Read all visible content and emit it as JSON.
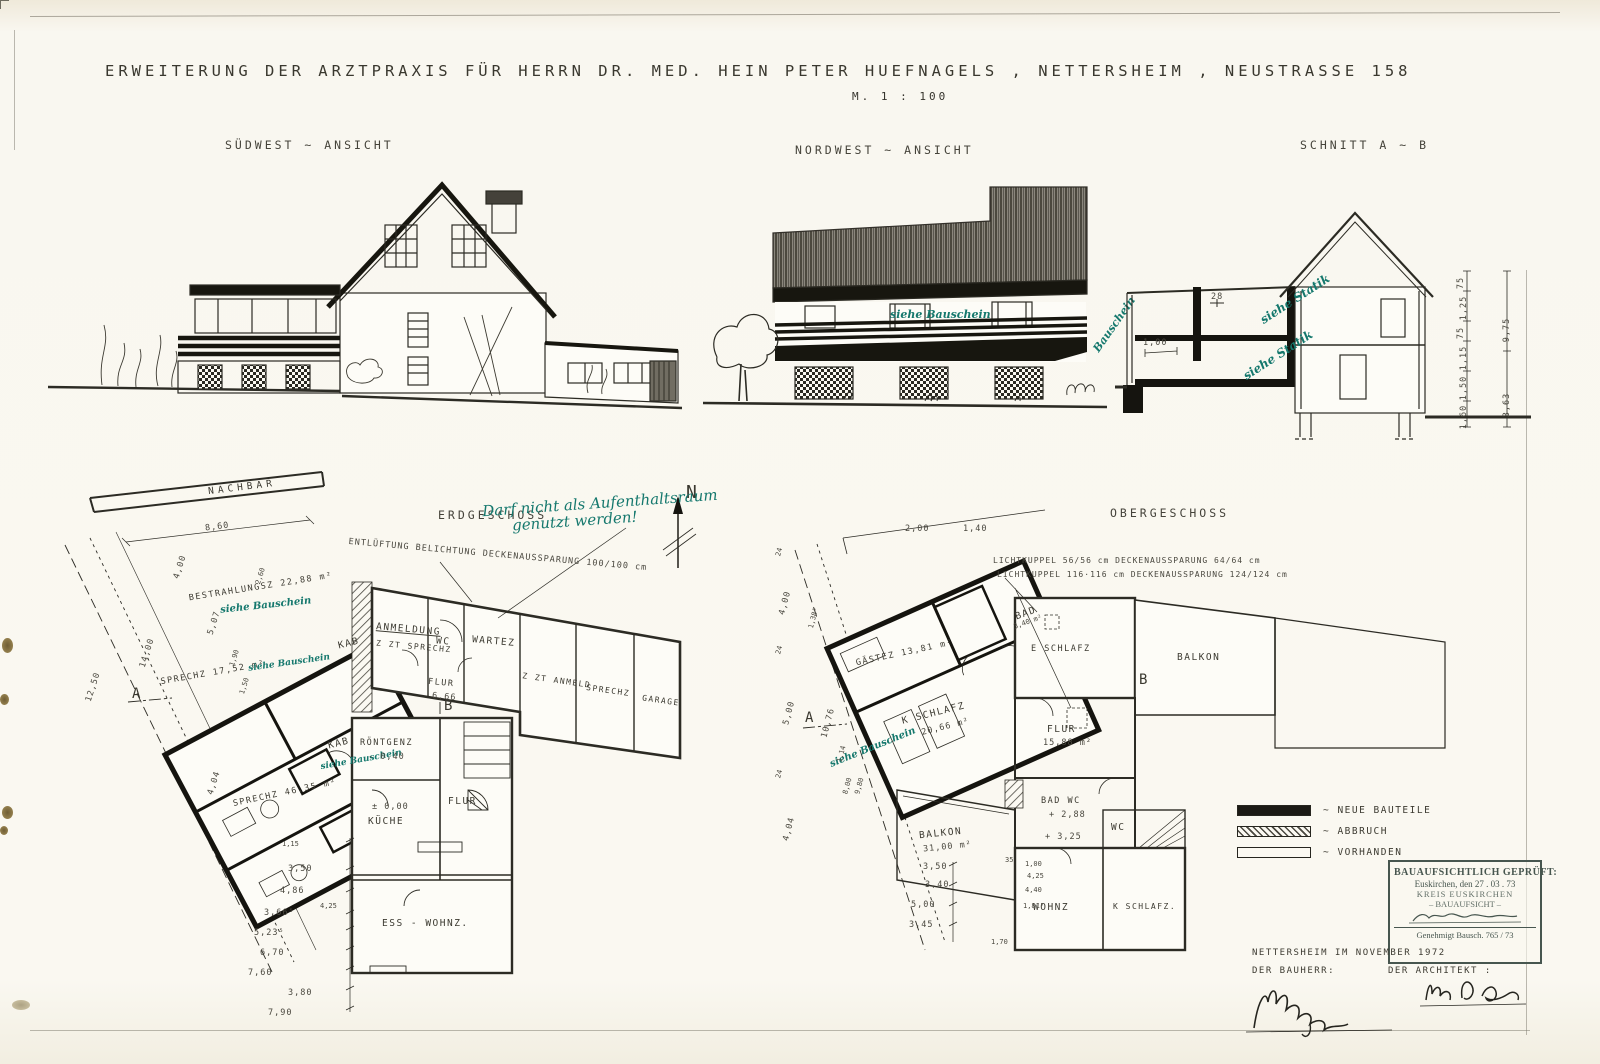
{
  "title": {
    "main": "ERWEITERUNG  DER  ARZTPRAXIS  FÜR  HERRN  DR. MED.  HEIN  PETER  HUEFNAGELS  , NETTERSHEIM ,  NEUSTRASSE   158",
    "scale": "M. 1 : 100"
  },
  "views": {
    "sw": "SÜDWEST  ~ ANSICHT",
    "nw": "NORDWEST  ~ ANSICHT",
    "schnitt": "SCHNITT   A ~ B"
  },
  "nw": {
    "siehe": "siehe Bauschein",
    "bauschein_rot": "Bauschein"
  },
  "schnitt": {
    "statik1": "siehe Statik",
    "statik2": "siehe Statik",
    "lvl": "28",
    "dim100": "1,00",
    "dims": [
      "75",
      "1,25",
      "75",
      "1,15",
      "1,50",
      "1,60"
    ],
    "dims2": [
      "9,75",
      "3,63"
    ]
  },
  "eg": {
    "title": "ERDGESCHOSS",
    "compass": "N",
    "nachbar": "NACHBAR",
    "dim860": "8,60",
    "note1": "Darf nicht als Aufenthaltsraum",
    "note2": "genutzt werden!",
    "vent": "ENTLÜFTUNG  BELICHTUNG  DECKENAUSSPARUNG  100/100 cm",
    "rooms": {
      "bestrahlungsz": "BESTRAHLUNGSZ  22,88 m²",
      "siehe1": "siehe Bauschein",
      "sprechz1": "SPRECHZ  17,52 m²",
      "siehe2": "siehe Bauschein",
      "kab1": "KAB",
      "kab2": "KAB",
      "siehe3": "siehe Bauschein",
      "sprechz3": "SPRECHZ  46,35 m²",
      "anmeldung1": "ANMELDUNG",
      "anmeldung2": "Z ZT SPRECHZ",
      "wc": "WC",
      "wartez": "WARTEZ",
      "flur1": "FLUR",
      "flur1v": "6,66",
      "zztanmeld": "Z ZT ANMELD",
      "sprechz2": "SPRECHZ",
      "garage": "GARAGE",
      "roentgenz": "RÖNTGENZ",
      "roentgenzv": "- 0,40",
      "kueche1": "± 0,00",
      "kueche2": "KÜCHE",
      "flur2": "FLUR",
      "esswohnz": "ESS - WOHNZ."
    },
    "markers": {
      "a": "A",
      "b": "B"
    },
    "dimsL": [
      "4,00",
      "14,00",
      "12,50",
      "5,07",
      "1,90",
      "1,50",
      "2,60",
      "4,04"
    ],
    "dimsB": [
      "1,15",
      "3,50",
      "4,86",
      "3,66⁵",
      "4,25",
      "5,23⁵",
      "6,70",
      "7,60",
      "3,80",
      "7,90"
    ]
  },
  "og": {
    "title": "OBERGESCHOSS",
    "lk1": "LICHTKUPPEL  56/56 cm   DECKENAUSSPARUNG  64/64 cm",
    "lk2": "LICHTKUPPEL  116·116 cm   DECKENAUSSPARUNG  124/124 cm",
    "rooms": {
      "bad": "BAD",
      "badv": "3,40 m²",
      "gaestez": "GÄSTEZ  13,81 m²",
      "kschlafz1": "K SCHLAFZ",
      "kschlafz1v": "20,66 m²",
      "siehe": "siehe Bauschein",
      "eschlafz": "E SCHLAFZ",
      "balkon1": "BALKON",
      "flur": "FLUR",
      "flurv": "15,88 m²",
      "badwc": "BAD  WC",
      "badwcv": "+ 2,88",
      "balkon2": "BALKON",
      "balkon2v": "31,00 m²",
      "level": "+ 3,25",
      "wc": "WC",
      "wohnz": "WOHNZ",
      "kschlafz2": "K SCHLAFZ."
    },
    "markers": {
      "a": "A",
      "b": "B"
    },
    "dimsT": [
      "2,00",
      "1,40"
    ],
    "dimsL": [
      "24",
      "4,00",
      "1,38⁵",
      "24",
      "5,00",
      "10,76",
      "24",
      "4,04",
      "1,14",
      "8,00",
      "9,80"
    ],
    "dimsB": [
      "3,50",
      "3,40",
      "5,00",
      "3,45",
      "1,70"
    ],
    "dimsC": [
      "35",
      "1,00",
      "4,25",
      "4,40",
      "1,81⁵"
    ]
  },
  "legend": {
    "items": [
      {
        "label": "~ NEUE  BAUTEILE",
        "style": "solid"
      },
      {
        "label": "~ ABBRUCH",
        "style": "hatch"
      },
      {
        "label": "~ VORHANDEN",
        "style": "outline"
      }
    ]
  },
  "stamp": {
    "line1": "BAUAUFSICHTLICH GEPRÜFT:",
    "line2": "Euskirchen, den 27 . 03 . 73",
    "line3": "KREIS EUSKIRCHEN",
    "line4": "– BAUAUFSICHT –",
    "line5": "Genehmigt   Bausch.  765 / 73"
  },
  "footer": {
    "place": "NETTERSHEIM    IM    NOVEMBER    1972",
    "bauherr": "DER   BAUHERR:",
    "architekt": "DER   ARCHITEKT :"
  },
  "colors": {
    "paper": "#faf8f1",
    "ink": "#2c2b24",
    "teal": "#15786d",
    "roof": "#5b5850"
  }
}
